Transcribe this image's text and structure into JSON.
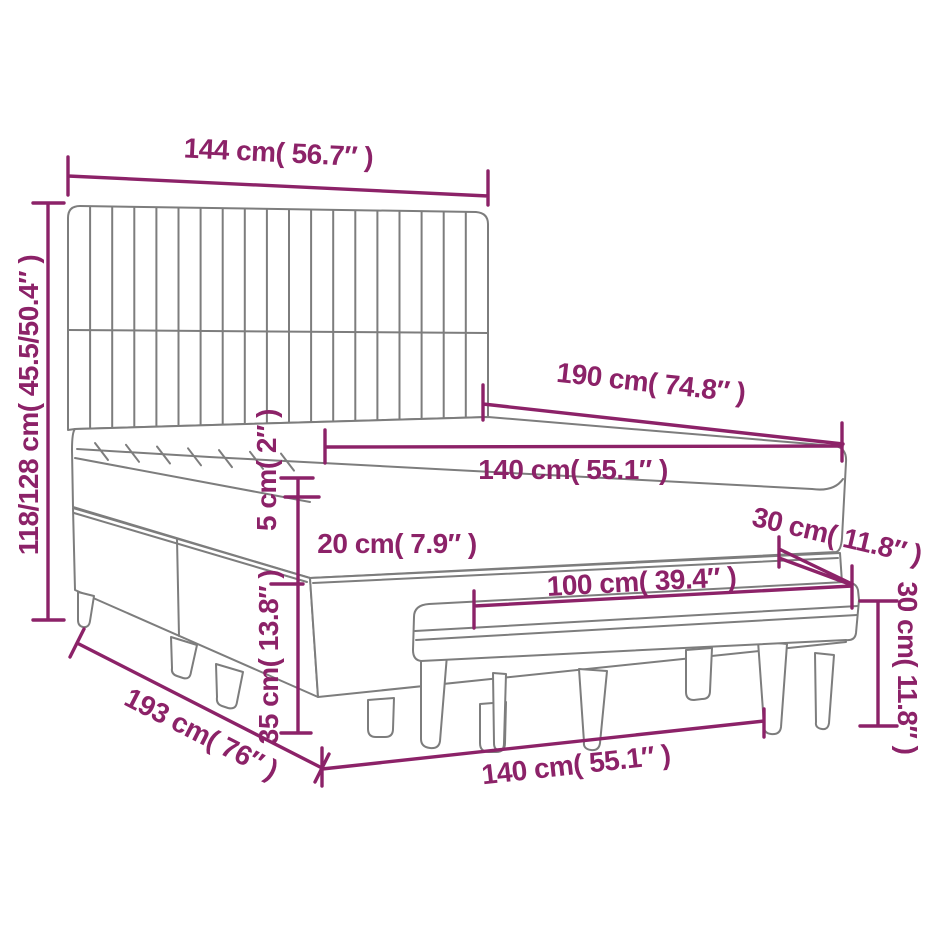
{
  "colors": {
    "dimension": "#8c2268",
    "artwork": "#7d7d7d",
    "background": "#ffffff"
  },
  "dims": {
    "headboard_width": "144 cm( 56.7″ )",
    "total_height": "118/128 cm( 45.5/50.4″ )",
    "mattress_length": "190 cm( 74.8″ )",
    "mattress_width": "140 cm( 55.1″ )",
    "topper_height": "5 cm( 2″ )",
    "mattress_height": "20 cm( 7.9″ )",
    "base_height": "35 cm( 13.8″ )",
    "bench_depth": "30 cm( 11.8″ )",
    "bench_length": "100 cm( 39.4″ )",
    "bench_height": "30 cm( 11.8″ )",
    "bed_width": "140 cm( 55.1″ )",
    "bed_length": "193 cm( 76″ )"
  }
}
